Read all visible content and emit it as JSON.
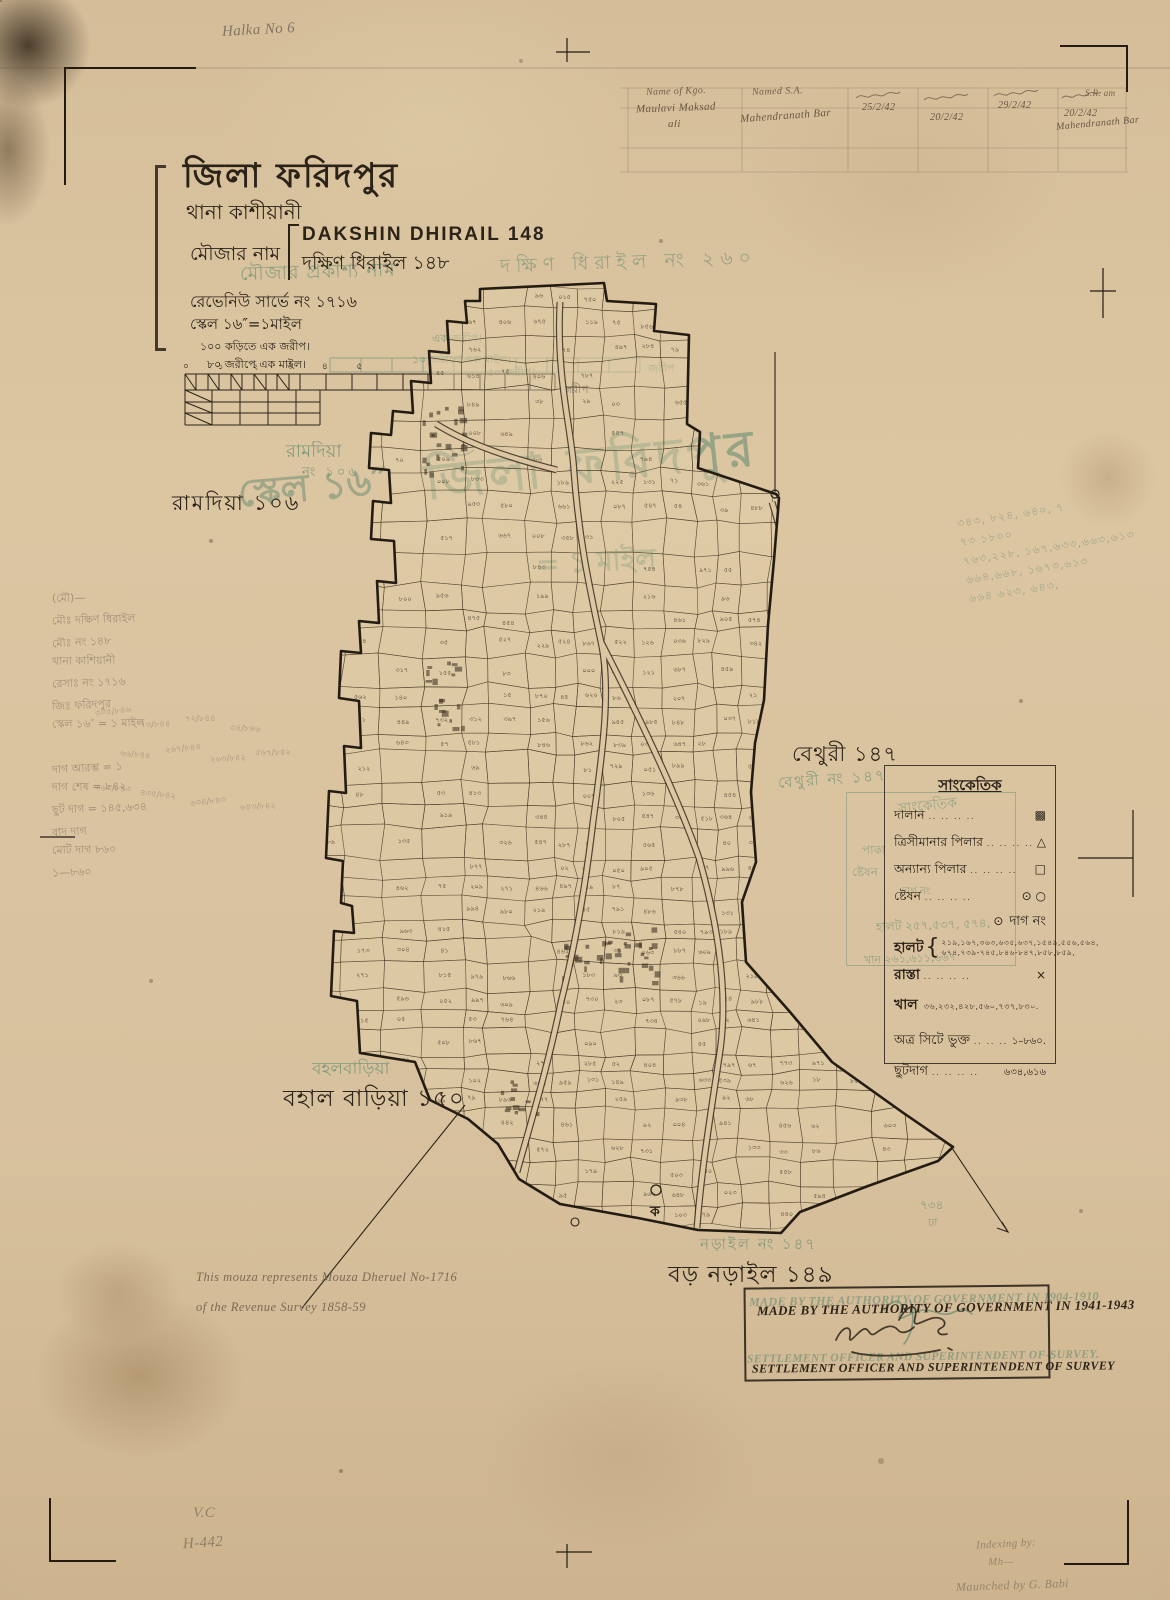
{
  "header": {
    "halka_note": "Halka No 6",
    "district": "জিলা ফরিদপুর",
    "thana": "থানা কাশীয়ানী",
    "mouza_label": "মৌজার নাম",
    "name_latin": "DAKSHIN DHIRAIL 148",
    "name_bengali": "দক্ষিণ ধিরাইল ১৪৮",
    "revenue_survey": "রেভেনিউ সার্ভে নং ১৭১৬",
    "scale": "স্কেল ১৬″=১মাইল",
    "kori_note": "১০০ কড়িতে এক জরীপ।",
    "jarip_note": "৮০ জরীপে এক মাইল।",
    "scale_bar_digits": "০ ১ ২ ৩ ৪ ৫",
    "scale_bar_unit": "জরীপ"
  },
  "ghost": {
    "mouza_public_name": "মৌজার প্রকাশ্য নাম",
    "public_name_value": "দক্ষিণ ধিরাইল নং ২৬০",
    "district_large": "জিলা ফরিদপুর",
    "scale_big": "স্কেল ১৬″",
    "mile_big": "= ১ মাইল",
    "jarip_small": "এক জরীপ।",
    "mile_small": "১০ জরীপে এক মাইল।",
    "jarip_50": "৫০ জরীপ।",
    "stamp_line1": "MADE BY THE AUTHORITY OF GOVERNMENT IN 1904-1910",
    "stamp_line2": "SETTLEMENT OFFICER AND SUPERINTENDENT OF-SURVEY.",
    "legend_title": "সাংকেতিক",
    "legend_paka": "পাকা",
    "legend_steshon": "ষ্টেষন",
    "legend_dag": "দাগ নং",
    "legend_halot": "হালট ২৫৭,৫৩৭, ৫৭৪,",
    "legend_khan": "খান ২৬১,৬১১,৬৬৭",
    "bottom_734": "৭৩৪",
    "bottom_dha": "ঢা"
  },
  "neighbors": {
    "ramdia_green_1": "রামদিয়া",
    "ramdia_green_2": "নং ১০৬",
    "ramdia_black": "রামদিয়া ১০৬",
    "bethuri_black": "বেথুরী ১৪৭",
    "bethuri_green": "বেথুরী নং ১৪৭",
    "bahal_green": "বহলবাড়িয়া",
    "bahal_black": "বহাল বাড়িয়া ১৫০",
    "naral_green": "নড়াইল নং ১৪৭",
    "naral_black": "বড় নড়াইল ১৪৯"
  },
  "legend": {
    "title": "সাংকেতিক",
    "leader": ".. .. .. ..",
    "rows": [
      {
        "label": "দালান",
        "symbol": "▩"
      },
      {
        "label": "ত্রিসীমানার পিলার",
        "symbol": "△"
      },
      {
        "label": "অন্যান্য পিলার",
        "symbol": "□"
      },
      {
        "label": "ষ্টেষন",
        "symbol": "⊙ ○"
      }
    ],
    "dag_symbol": "⊙",
    "dag_label": "দাগ নং",
    "halot_label": "হালট",
    "halot_numbers_1": "২১৯,১৬৭,৩৬৩,৬৩৫,৬৩৭,১৫৪৯,৫৫৬,৫৬৪,",
    "halot_numbers_2": "৬৭৪,৭৩৯-৭৪৫,৮৪৬-৮৪৭,৮৫৮,৮৫৯,",
    "rasta_label": "রাস্তা",
    "rasta_mark": "×",
    "khal_label": "খাল",
    "khal_numbers": "৩৬,২৩২,৪২৮,৫৬০,৭৩৭,৮৩০.",
    "sheet_label": "অত্র সিটে ভুক্ত",
    "sheet_value": "১–৮৬০.",
    "chhutdag_label": "ছুটদাগ",
    "chhutdag_value": "৬৩৪,৬১৬"
  },
  "table": {
    "header_1": "Name of Kgo.",
    "header_2": "Named S.A.",
    "header_7": "S.R. am",
    "name_1a": "Maulavi Maksad",
    "name_1b": "ali",
    "name_2": "Mahendranath Bar",
    "date_1": "25/2/42",
    "date_2": "20/2/42",
    "date_3": "29/2/42",
    "date_4": "20/2/42",
    "name_3": "Mahendranath Bar"
  },
  "notes": {
    "mouza_note_1": "This mouza represents Mouza Dheruel No-1716",
    "mouza_note_2": "of the Revenue Survey 1858-59",
    "left_pencil": [
      "(মৌ)—",
      "মৌঃ দক্ষিণ ধিরাইল",
      "মৌঃ নং  ১৪৮",
      "থানা কাশিয়ানী",
      "রেসাঃ নং ১৭১৬",
      "জিঃ ফরিদপুর",
      "স্কেল ১৬″ = ১ মাইল",
      "",
      "দাগ আরম্ভ = ১",
      "দাগ শেষ = ৮৪২",
      "ছুট দাগ = ১৪৫,৬৩৪",
      "বাদ দাগ",
      "মোট দাগ  ৮৬০",
      "১—৮৬০"
    ],
    "fractions": [
      "৩০৫/৮৪৬",
      "৭৩/৮৪৪",
      "৭২/৮৪৪",
      "৩৪/৮৪৬",
      "৬৬/৮৪৪",
      "২৬৭/৮৪৪",
      "২৬৩/৮৪২",
      "৫৬৭/৮৪২",
      "৩৬৩/৮৪৩",
      "৪৩৫/৮৪২",
      "৬৩৪/৮৪৩",
      "৬৪৩/৮৪২"
    ],
    "green_right": [
      "৩৪৩, ৮২৪, ৬৪০, ৭",
      "৭৩   ১৮০০",
      "৭৬৩,২২৮, ১৬৭,৬৩৩,৬৬৩,৬১৩",
      "৬৬৪,৬৬৮, ১৬৭৩,৬১৩",
      "৬৬৪  ৬২৩, ৬৪৩,"
    ],
    "pencil_vc": "V.C",
    "pencil_h442": "H-442",
    "pencil_indexing_1": "Indexing by:",
    "pencil_indexing_2": "Mh—",
    "pencil_checked": "Maunched by  G. Babi",
    "marker_ka": "ক"
  },
  "stamp": {
    "line1": "MADE BY THE AUTHORITY OF GOVERNMENT IN 1941-1943",
    "line2": "SETTLEMENT OFFICER AND SUPERINTENDENT OF SURVEY"
  },
  "map": {
    "numerals": "০১২৩৪৫৬৭৮৯"
  },
  "colors": {
    "paper": "#d8c19e",
    "ink": "#2b2218",
    "ghost_green": "#6e8f74",
    "pencil": "#6e6354"
  }
}
